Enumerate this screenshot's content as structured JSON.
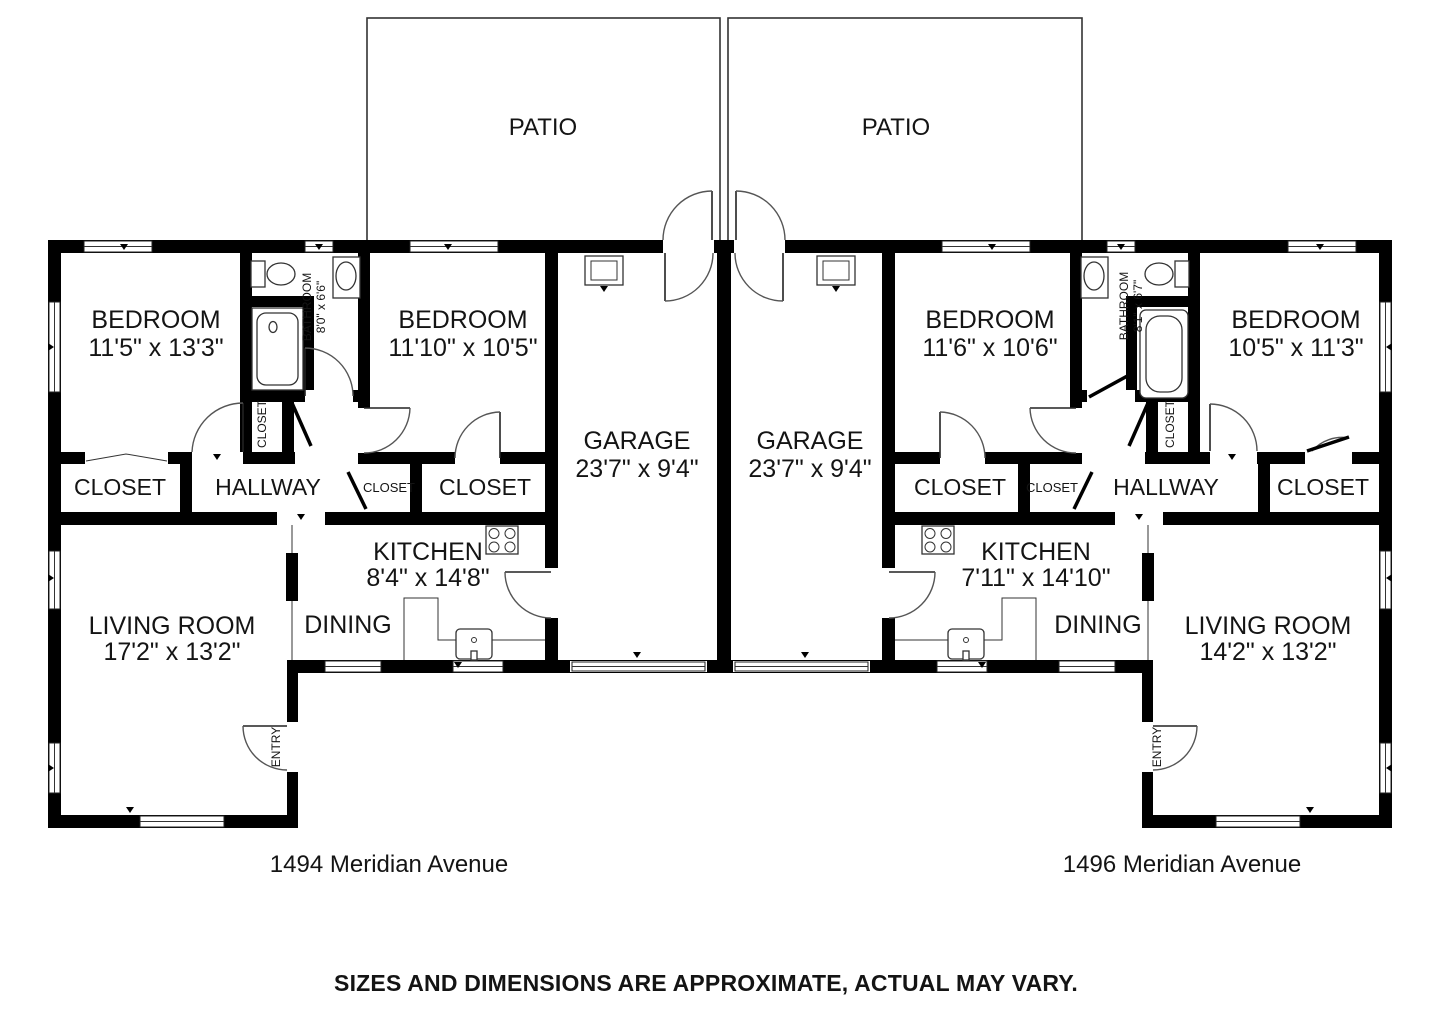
{
  "unit_left": {
    "address": "1494 Meridian Avenue",
    "patio": "PATIO",
    "bedroom1": {
      "name": "BEDROOM",
      "dims": "11'5\" x 13'3\""
    },
    "bedroom2": {
      "name": "BEDROOM",
      "dims": "11'10\" x 10'5\""
    },
    "bathroom": {
      "name": "BATHROOM",
      "dims": "8'0\" x 6'6\""
    },
    "garage": {
      "name": "GARAGE",
      "dims": "23'7\" x 9'4\""
    },
    "kitchen": {
      "name": "KITCHEN",
      "dims": "8'4\" x 14'8\""
    },
    "living_room": {
      "name": "LIVING ROOM",
      "dims": "17'2\" x 13'2\""
    },
    "dining": "DINING",
    "hallway": "HALLWAY",
    "entry": "ENTRY",
    "closet_bedroom1": "CLOSET",
    "closet_bathroom": "CLOSET",
    "closet_hallway": "CLOSET",
    "closet_bedroom2": "CLOSET"
  },
  "unit_right": {
    "address": "1496 Meridian Avenue",
    "patio": "PATIO",
    "bedroom1": {
      "name": "BEDROOM",
      "dims": "11'6\" x 10'6\""
    },
    "bedroom2": {
      "name": "BEDROOM",
      "dims": "10'5\" x 11'3\""
    },
    "bathroom": {
      "name": "BATHROOM",
      "dims": "8'1\" x 6'7\""
    },
    "garage": {
      "name": "GARAGE",
      "dims": "23'7\" x 9'4\""
    },
    "kitchen": {
      "name": "KITCHEN",
      "dims": "7'11\" x 14'10\""
    },
    "living_room": {
      "name": "LIVING ROOM",
      "dims": "14'2\" x 13'2\""
    },
    "dining": "DINING",
    "hallway": "HALLWAY",
    "entry": "ENTRY",
    "closet_bedroom1": "CLOSET",
    "closet_bathroom": "CLOSET",
    "closet_hallway": "CLOSET",
    "closet_bedroom2": "CLOSET"
  },
  "footer": {
    "disclaimer": "SIZES AND DIMENSIONS ARE APPROXIMATE, ACTUAL MAY VARY."
  }
}
